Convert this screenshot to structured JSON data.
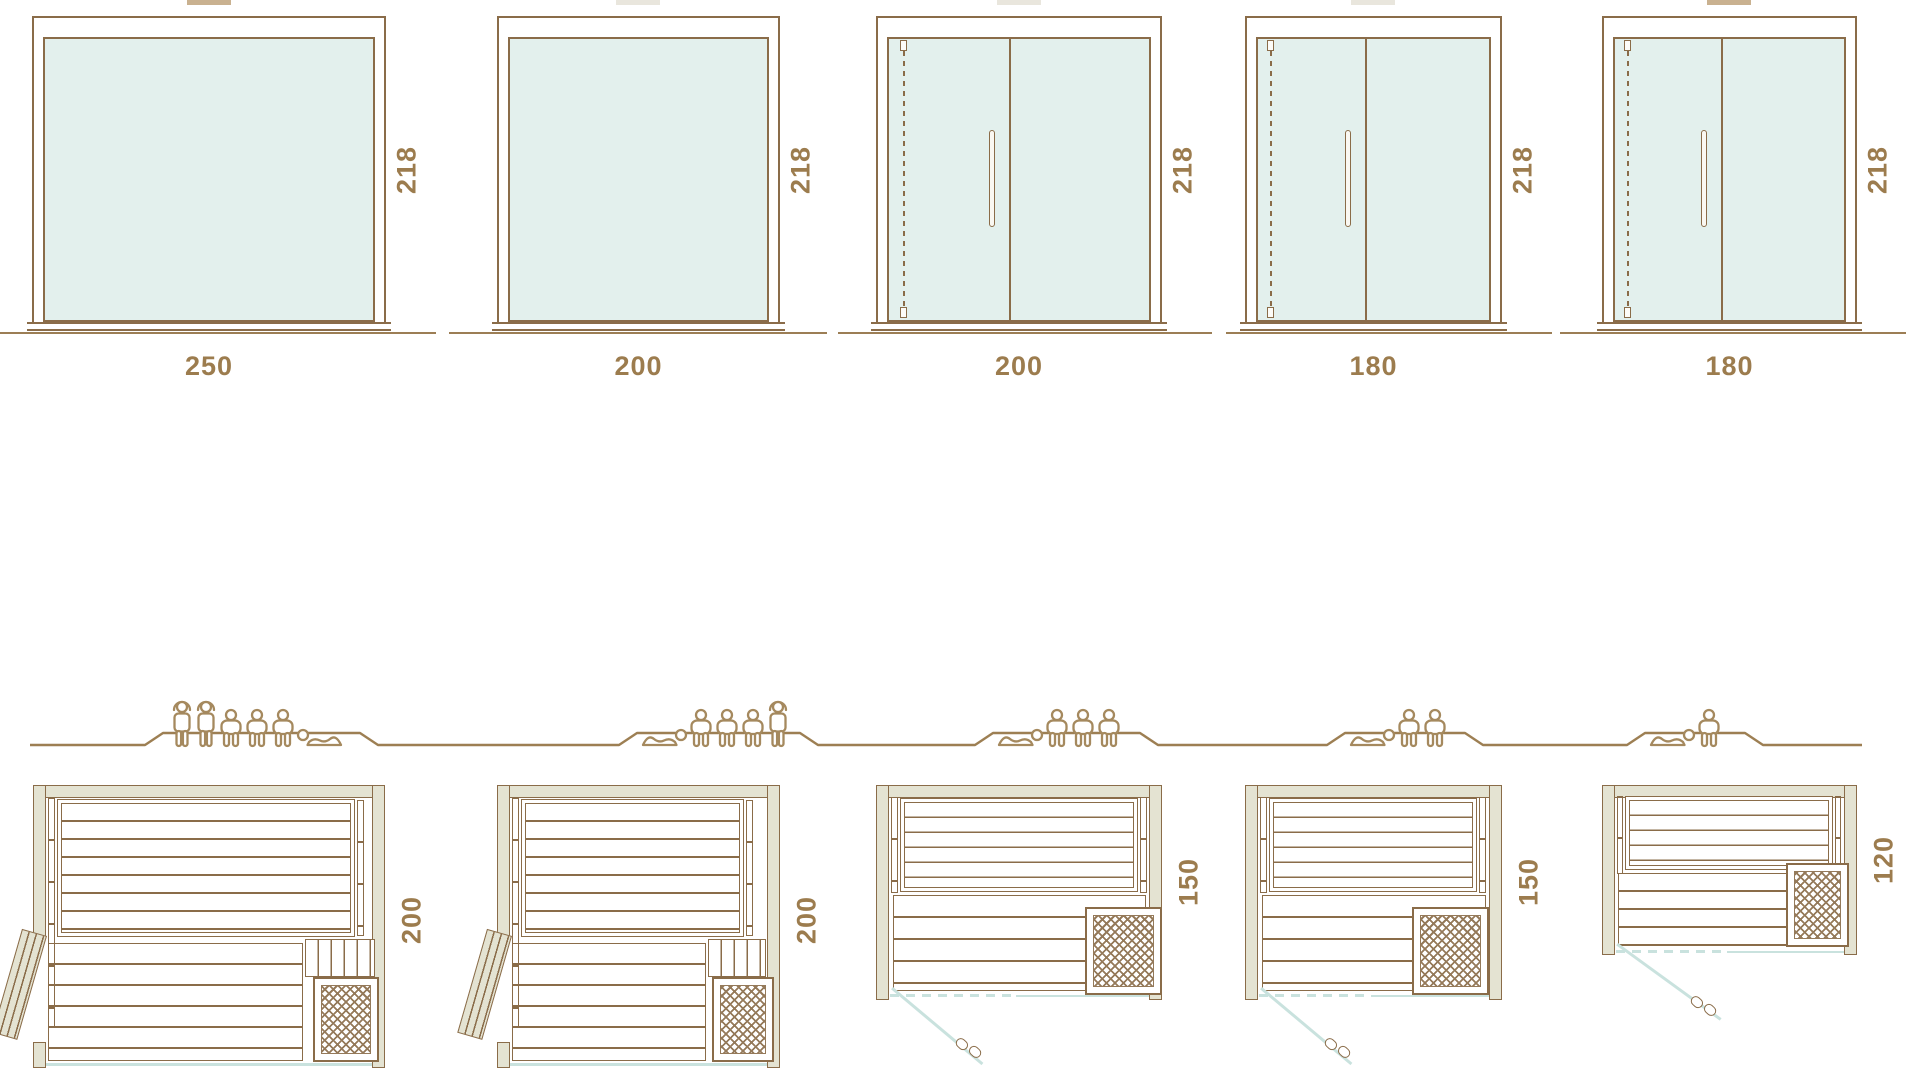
{
  "diagram": {
    "title_note": "sauna size comparison diagram",
    "units": [
      {
        "width": "250",
        "height": "218",
        "depth": "200",
        "capacity": {
          "figures": [
            "standing",
            "standing",
            "sitting",
            "sitting",
            "sitting",
            "lying"
          ]
        }
      },
      {
        "width": "200",
        "height": "218",
        "depth": "200",
        "capacity": {
          "figures": [
            "lying",
            "sitting",
            "sitting",
            "sitting",
            "standing"
          ]
        }
      },
      {
        "width": "200",
        "height": "218",
        "depth": "150",
        "capacity": {
          "figures": [
            "lying",
            "sitting",
            "sitting",
            "sitting"
          ]
        }
      },
      {
        "width": "180",
        "height": "218",
        "depth": "150",
        "capacity": {
          "figures": [
            "lying",
            "sitting",
            "sitting"
          ]
        }
      },
      {
        "width": "180",
        "height": "218",
        "depth": "120",
        "capacity": {
          "figures": [
            "lying",
            "sitting"
          ]
        }
      }
    ],
    "colors": {
      "line": "#8a6c49",
      "text": "#9c7c4e",
      "wall": "#e4e3d2",
      "glass": "#e3f0ed",
      "glassline": "#c9e2de",
      "people": "#a5895e",
      "tab_dark": "#c9b190",
      "tab_light": "#e9e6dd"
    }
  }
}
